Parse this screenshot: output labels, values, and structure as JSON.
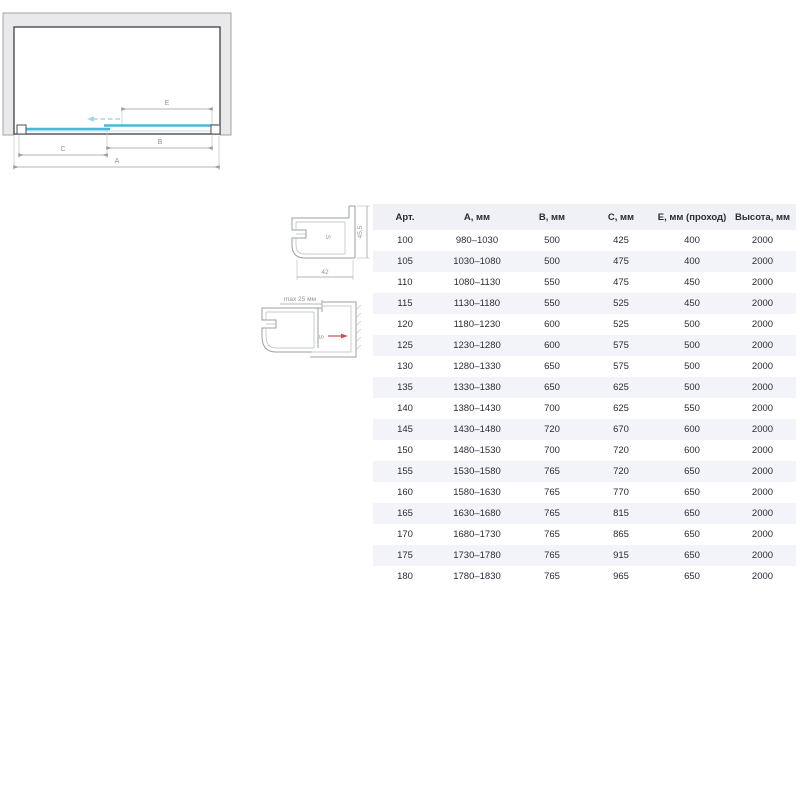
{
  "colors": {
    "glass_accent": "#4db6d9",
    "glass_pale": "#b9e2ef",
    "glass_dashed": "#9ed7e9",
    "wall_fill": "#e9e9eb",
    "wall_border": "#a3a3a7",
    "outline_dark": "#4b4c51",
    "dim_line": "#9b9ea4",
    "dim_text": "#8f939b",
    "red_arrow": "#c2544c",
    "table_text": "#2b2c35",
    "table_stripe": "#f3f4f9",
    "table_header_bg": "#f0f1f5"
  },
  "diagram": {
    "labels": {
      "a": "A",
      "b": "B",
      "c": "C",
      "e": "E"
    }
  },
  "profiles": {
    "profile1": {
      "width_label": "42",
      "height_label": "45,5"
    },
    "profile2": {
      "max_label": "max 25 мм"
    }
  },
  "table": {
    "headers": [
      "Арт.",
      "А, мм",
      "В, мм",
      "С, мм",
      "Е, мм (проход)",
      "Высота, мм"
    ],
    "rows": [
      [
        "100",
        "980–1030",
        "500",
        "425",
        "400",
        "2000"
      ],
      [
        "105",
        "1030–1080",
        "500",
        "475",
        "400",
        "2000"
      ],
      [
        "110",
        "1080–1130",
        "550",
        "475",
        "450",
        "2000"
      ],
      [
        "115",
        "1130–1180",
        "550",
        "525",
        "450",
        "2000"
      ],
      [
        "120",
        "1180–1230",
        "600",
        "525",
        "500",
        "2000"
      ],
      [
        "125",
        "1230–1280",
        "600",
        "575",
        "500",
        "2000"
      ],
      [
        "130",
        "1280–1330",
        "650",
        "575",
        "500",
        "2000"
      ],
      [
        "135",
        "1330–1380",
        "650",
        "625",
        "500",
        "2000"
      ],
      [
        "140",
        "1380–1430",
        "700",
        "625",
        "550",
        "2000"
      ],
      [
        "145",
        "1430–1480",
        "720",
        "670",
        "600",
        "2000"
      ],
      [
        "150",
        "1480–1530",
        "700",
        "720",
        "600",
        "2000"
      ],
      [
        "155",
        "1530–1580",
        "765",
        "720",
        "650",
        "2000"
      ],
      [
        "160",
        "1580–1630",
        "765",
        "770",
        "650",
        "2000"
      ],
      [
        "165",
        "1630–1680",
        "765",
        "815",
        "650",
        "2000"
      ],
      [
        "170",
        "1680–1730",
        "765",
        "865",
        "650",
        "2000"
      ],
      [
        "175",
        "1730–1780",
        "765",
        "915",
        "650",
        "2000"
      ],
      [
        "180",
        "1780–1830",
        "765",
        "965",
        "650",
        "2000"
      ]
    ]
  }
}
